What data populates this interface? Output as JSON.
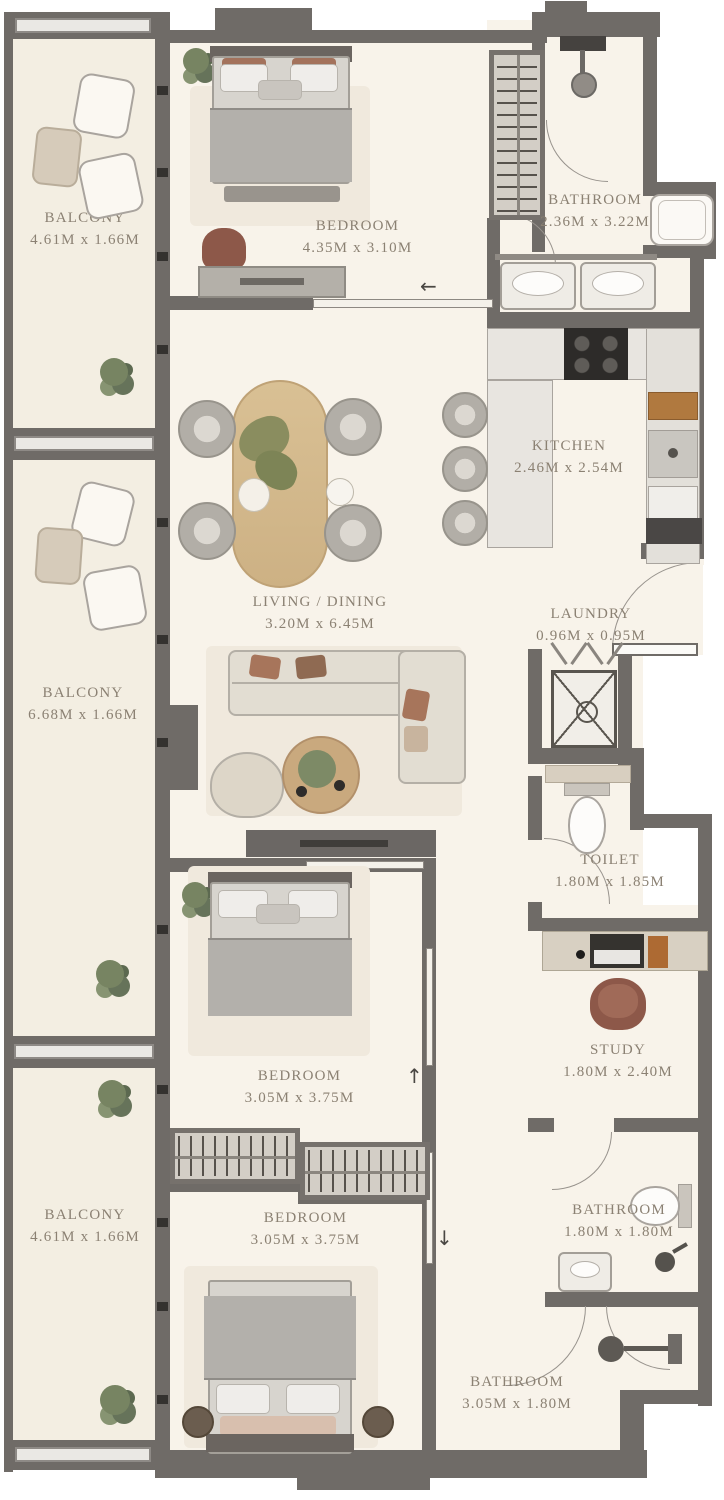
{
  "plan_type": "apartment floor plan",
  "rooms": {
    "balcony_top": {
      "name": "BALCONY",
      "dims": "4.61M x 1.66M"
    },
    "bedroom_top": {
      "name": "BEDROOM",
      "dims": "4.35M x 3.10M"
    },
    "bathroom_top": {
      "name": "BATHROOM",
      "dims": "2.36M x 3.22M"
    },
    "kitchen": {
      "name": "KITCHEN",
      "dims": "2.46M x 2.54M"
    },
    "living_dining": {
      "name": "LIVING / DINING",
      "dims": "3.20M x 6.45M"
    },
    "balcony_mid": {
      "name": "BALCONY",
      "dims": "6.68M x 1.66M"
    },
    "laundry": {
      "name": "LAUNDRY",
      "dims": "0.96M x 0.95M"
    },
    "toilet": {
      "name": "TOILET",
      "dims": "1.80M x 1.85M"
    },
    "study": {
      "name": "STUDY",
      "dims": "1.80M x 2.40M"
    },
    "bedroom_mid": {
      "name": "BEDROOM",
      "dims": "3.05M x 3.75M"
    },
    "bedroom_bottom": {
      "name": "BEDROOM",
      "dims": "3.05M x 3.75M"
    },
    "balcony_bottom": {
      "name": "BALCONY",
      "dims": "4.61M x 1.66M"
    },
    "bathroom_ensuite": {
      "name": "BATHROOM",
      "dims": "1.80M x 1.80M"
    },
    "bathroom_bottom": {
      "name": "BATHROOM",
      "dims": "3.05M x 1.80M"
    }
  },
  "arrows": {
    "bedroom_top_door": "←",
    "bedroom_mid_door": "↑",
    "bedroom_bottom_door": "↓"
  },
  "colors": {
    "wall": "#6f6b67",
    "floor": "#f8f3ea",
    "balcony_floor": "#f3eee2",
    "label_text": "#8b8173",
    "furniture_gray": "#b2aea7",
    "accent_brown": "#8d5849",
    "table_wood": "#d7bd92",
    "plant_green": "#778462",
    "stove_black": "#2d2b29"
  }
}
